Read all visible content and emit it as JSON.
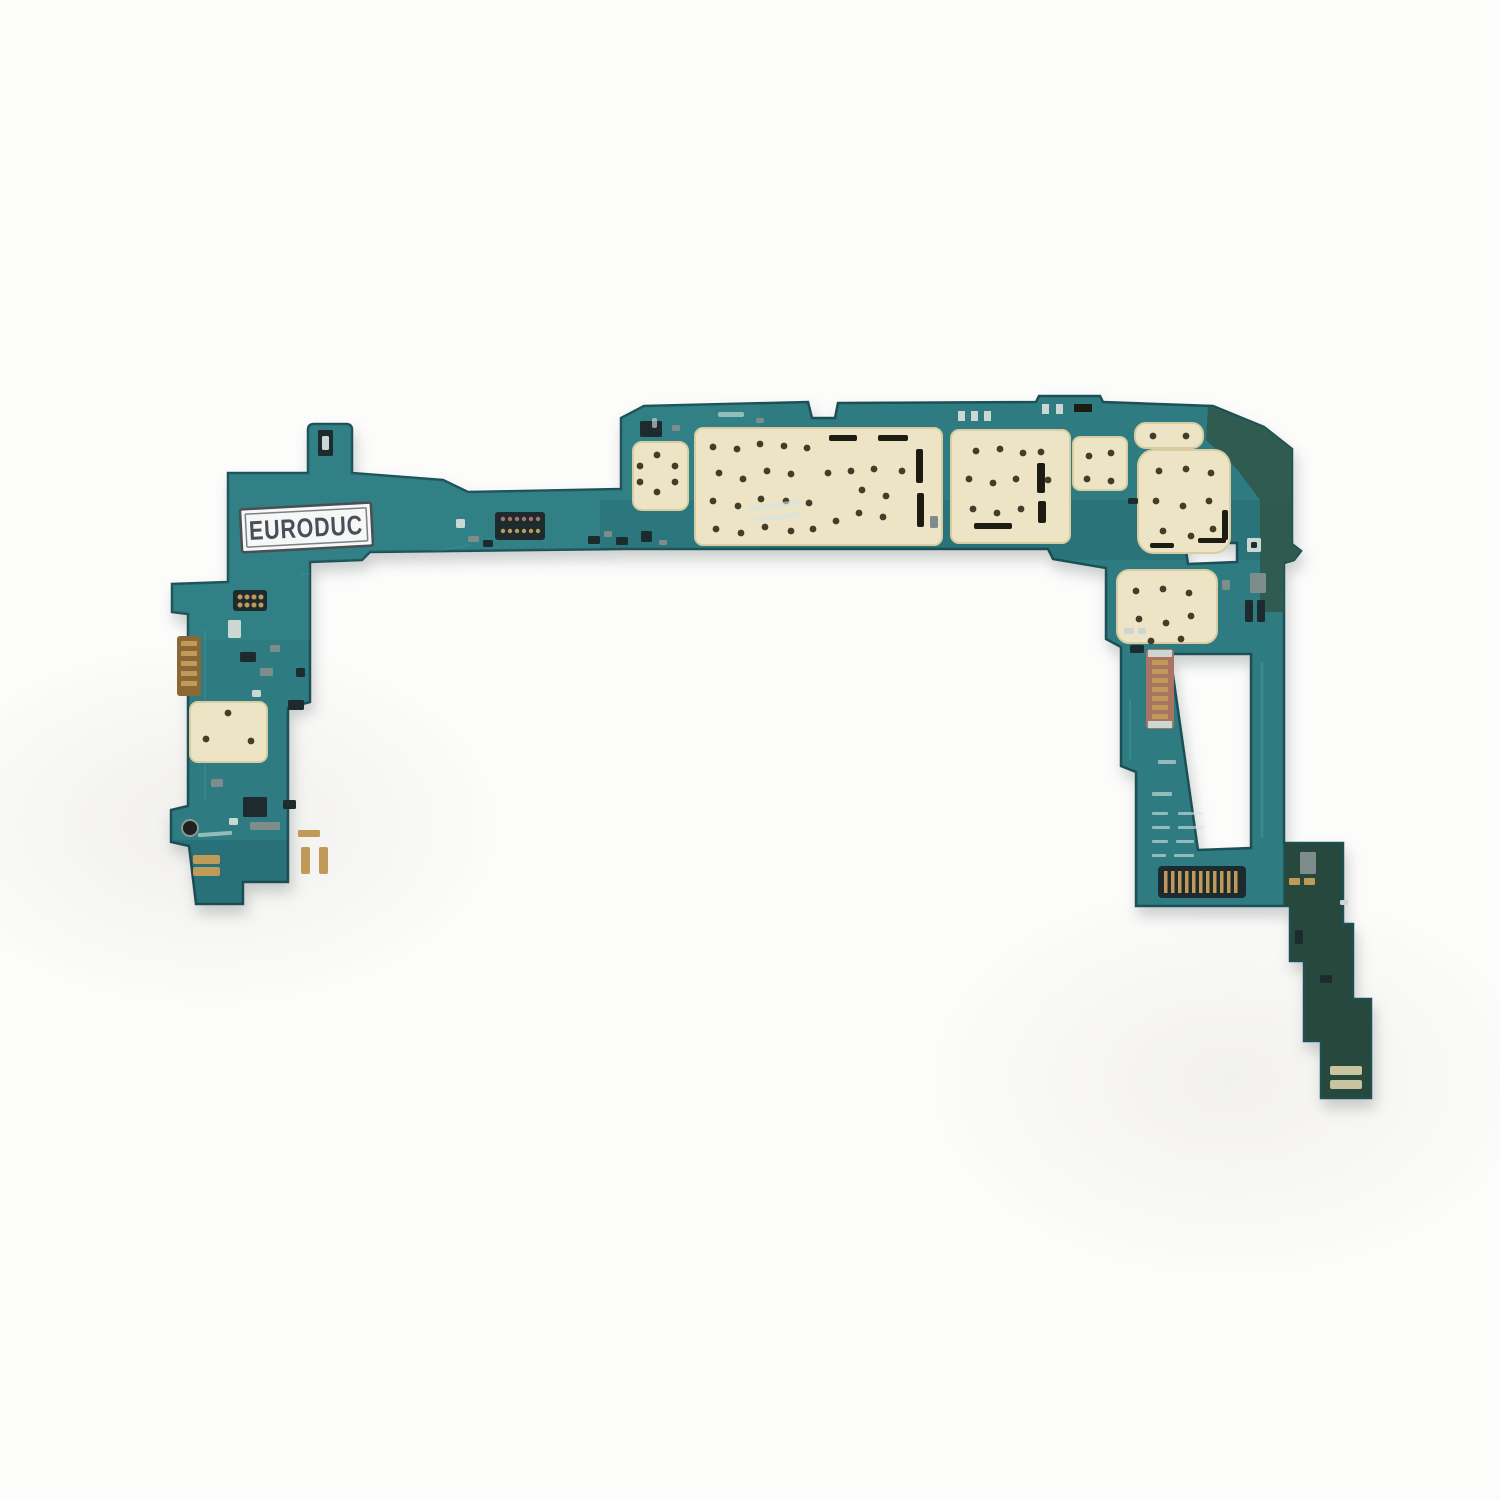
{
  "photo": {
    "subject": "Tablet motherboard logic board",
    "description": "Bare teal-green tablet logic board photographed flat on a plain white background. Large cream solder pads for EMI shields cover the main body, board-to-board connectors and small components populate the left and right arms, a dark olive corner section sits at the top right, and a dark green flex tail steps down at the lower right.",
    "sticker": {
      "text": "EURODUC"
    },
    "background": "plain white studio background with soft shadow under the board"
  },
  "colors": {
    "bg": "#fcfcfb",
    "board": "#2d7b82",
    "boardLight": "#3f949a",
    "boardEdge": "#1b5056",
    "cornerDark": "#2f5a4d",
    "tailDark": "#27493d",
    "pad": "#ece4c5",
    "padEdge": "#d8cda2",
    "via": "#423c28",
    "slot": "#1c1c12",
    "gold": "#c09a58",
    "goldDeep": "#8a6836",
    "salmon": "#aa7463",
    "metalLight": "#ccd6d2",
    "metalGray": "#7e8d8c",
    "partDark": "#1e2b2e",
    "labelBg": "#f7f8f6",
    "labelBorder": "#4a4e55",
    "labelText": "#494e58",
    "silk": "#d6e6e1",
    "shadow": "#8e9795"
  }
}
